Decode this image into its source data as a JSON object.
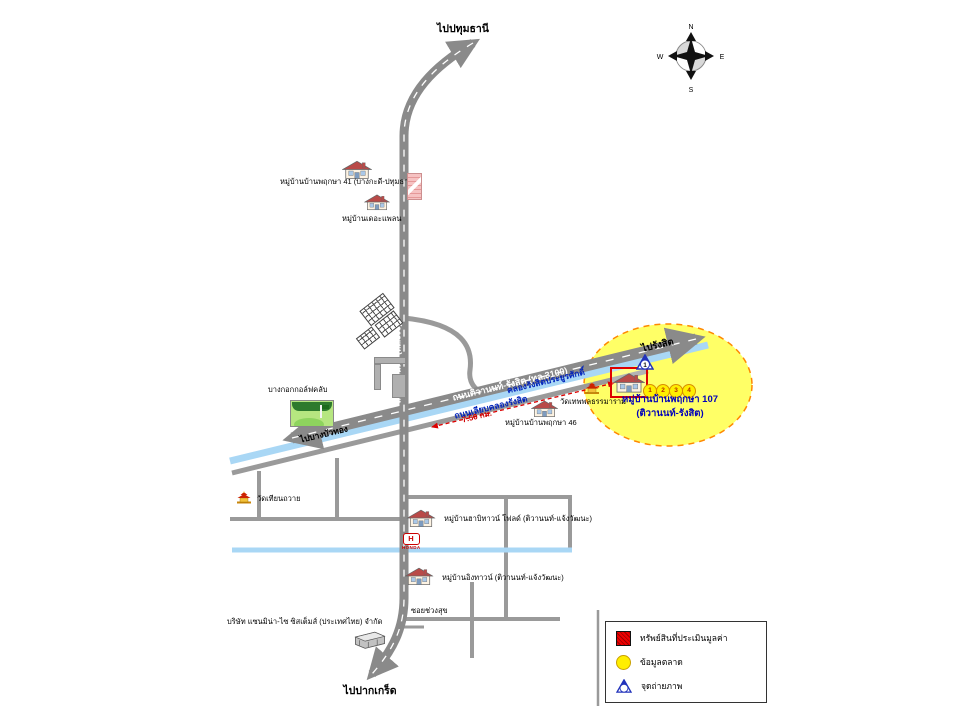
{
  "compass": {
    "n": "N",
    "e": "E",
    "s": "S",
    "w": "W"
  },
  "directions": {
    "north": "ไปปทุมธานี",
    "south": "ไปปากเกร็ด",
    "rangsit": "ไปรังสิต",
    "bangbuathong": "ไปบางบัวทอง"
  },
  "roads": {
    "tiwanon_vertical": "ถนนติวานนท์ (ทล.306)",
    "tiwanon_rangsit": "ถนนติวานนท์-รังสิต (ทล.3100)",
    "liap_khlong": "ถนนเลียบคลองรังสิต",
    "soi": "ซอยช่วงสุข"
  },
  "canal": {
    "name": "คลองรังสิตประยูรศักดิ์"
  },
  "distance": {
    "label": "7.50 กม."
  },
  "subject": {
    "name": "หมู่บ้านบ้านพฤกษา 107",
    "sub": "(ติวานนท์-รังสิต)",
    "photo_point": "1",
    "market_points": [
      "1",
      "2",
      "3",
      "4"
    ]
  },
  "landmarks": {
    "pruksa41": "หมู่บ้านบ้านพฤกษา 41 (บางกะดี-ปทุมธานี)",
    "theplan": "หมู่บ้านเดอะแพลน",
    "golf": "บางกอกกอล์ฟคลับ",
    "wat_thianthawai": "วัดเทียนถวาย",
    "pruksa46": "หมู่บ้านบ้านพฤกษา 46",
    "wat_theppol": "วัดเทพพลธรรมาราม",
    "habitown": "หมู่บ้านฮาบิทาวน์ โฟลด์ (ติวานนท์-แจ้งวัฒนะ)",
    "ingtown": "หมู่บ้านอิงทาวน์ (ติวานนท์-แจ้งวัฒนะ)",
    "sanmina": "บริษัท แซนมิน่า-ไซ ซิสเต็มส์ (ประเทศไทย) จำกัด",
    "honda": {
      "letter": "H",
      "name": "HONDA"
    }
  },
  "legend": {
    "appraised": "ทรัพย์สินที่ประเมินมูลค่า",
    "market": "ข้อมูลตลาด",
    "photo": "จุดถ่ายภาพ"
  },
  "colors": {
    "road_gray": "#8a8a8a",
    "canal_blue": "#a9d7f5",
    "highlight_yellow": "#ffff66",
    "highlight_border": "#ff8800",
    "subject_red": "#dd0000",
    "label_blue": "#0000bb",
    "marker_blue": "#2233bb",
    "legend_yellow": "#ffee00"
  }
}
